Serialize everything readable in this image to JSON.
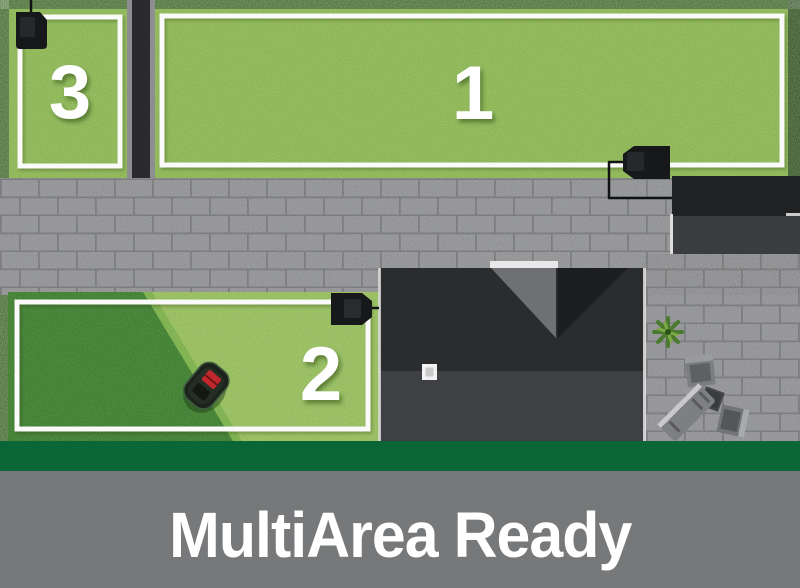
{
  "banner": {
    "title": "MultiArea Ready"
  },
  "zones": [
    {
      "id": 1,
      "label": "1",
      "position": "top-right lawn"
    },
    {
      "id": 2,
      "label": "2",
      "position": "bottom-left lawn, partially mowed"
    },
    {
      "id": 3,
      "label": "3",
      "position": "top-left lawn"
    }
  ],
  "objects": {
    "mower": "robotic-lawn-mower",
    "docks": [
      "charging-dock-zone-3",
      "charging-dock-zone-1",
      "charging-dock-zone-2"
    ],
    "buildings": [
      "house-roof",
      "garage-roof"
    ],
    "garden": [
      "hedge-border",
      "paved-driveway",
      "garden-path",
      "potted-plant",
      "patio-chair",
      "patio-lounger",
      "patio-table"
    ]
  },
  "colors": {
    "grass_light": "#92c153",
    "grass_uncut": "#418e2f",
    "hedge": "#3c6626",
    "paving": "#9c9d9f",
    "house_roof_dark": "#2b2c2e",
    "house_roof_light": "#3f4043",
    "accent_green_bar": "#0a6636",
    "footer_background": "#77787a",
    "label_white": "#ffffff",
    "mower_red": "#c1272d"
  }
}
